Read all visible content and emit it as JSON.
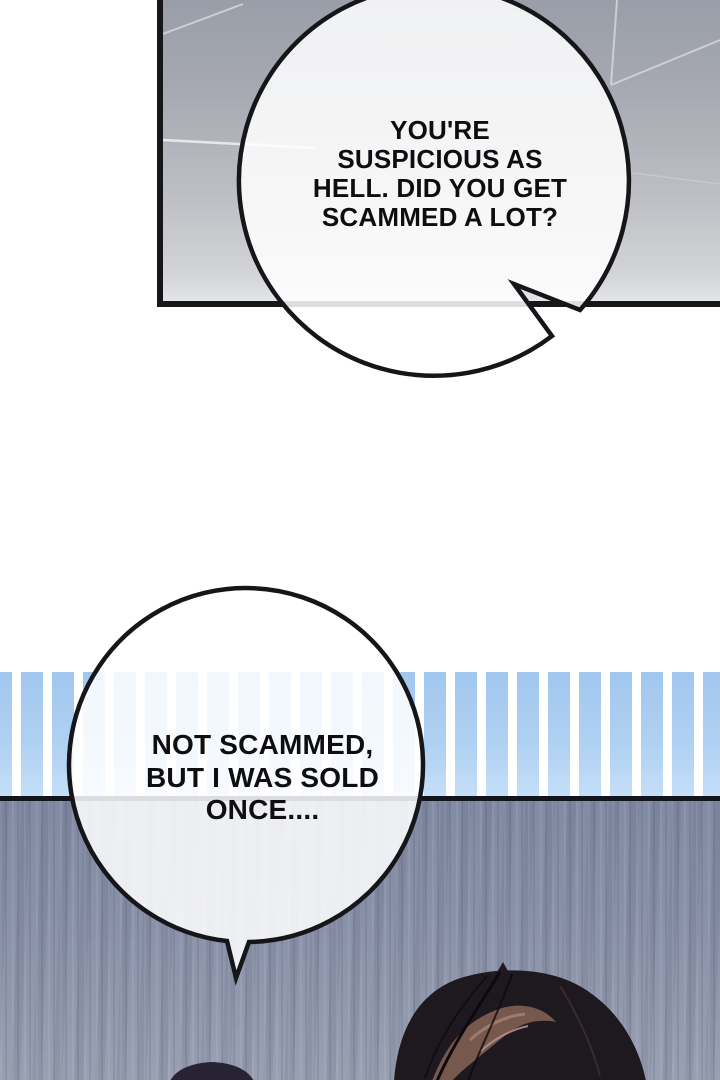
{
  "page": {
    "kind_label": "webtoon comic page"
  },
  "speech_bubbles": [
    {
      "id": "bubble-1",
      "text": "YOU'RE\nSUSPICIOUS AS\nHELL. DID YOU GET\nSCAMMED A LOT?"
    },
    {
      "id": "bubble-2",
      "text": "NOT SCAMMED,\nBUT I WAS SOLD\nONCE...."
    }
  ],
  "colors": {
    "outline": "#16161a",
    "ceiling_top": "#9fa3ac",
    "ceiling_bottom": "#d6d7da",
    "stripe_blue": "#a8cdf0",
    "stripe_gap": "#ffffff",
    "lower_panel": "#8a92aa",
    "panel_border": "#14141c",
    "hair_dark": "#1d191f",
    "hair_highlight": "#7b5c50",
    "bubble_fill": "#ffffff",
    "text": "#0e0e11"
  }
}
